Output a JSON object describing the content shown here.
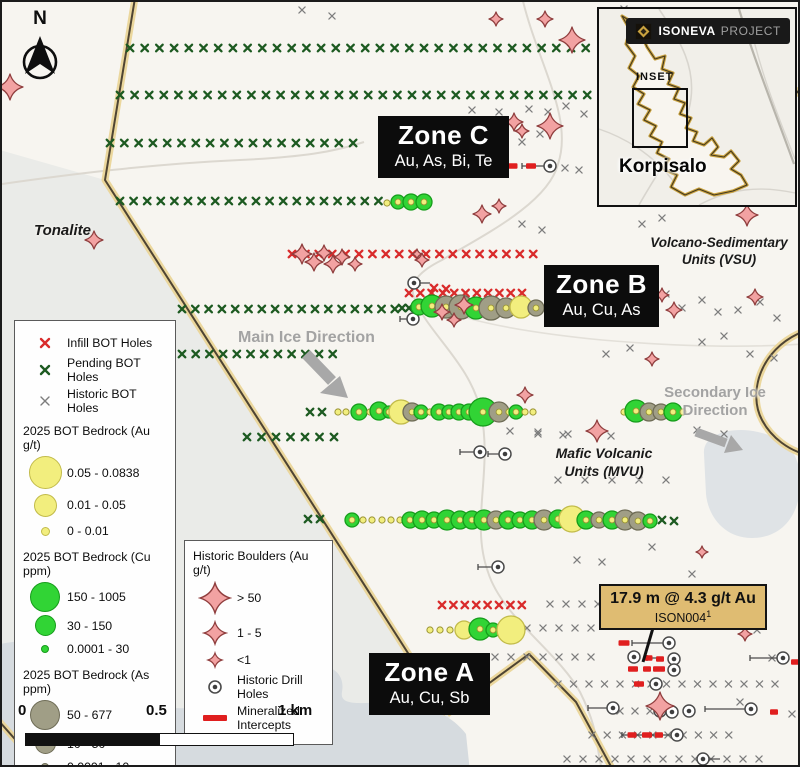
{
  "colors": {
    "map_bg": "#f7f5f0",
    "water": "#d6dbdf",
    "terrain": "#eaebe8",
    "patch": "#dfe3e6",
    "boundary_glow": "#ead598",
    "boundary_core": "#4e4433",
    "road": "#dcd8d0",
    "infill_x": "#d92b2b",
    "pending_x": "#1d5a21",
    "historic_x": "#7d7d7d",
    "au_fill": "#f2ee7e",
    "au_stroke": "#c2bb4a",
    "dot_stroke": "#9a9434",
    "cu_fill": "#31d435",
    "cu_stroke": "#169c1b",
    "as_fill": "#a09e86",
    "as_stroke": "#6e6c56",
    "boulder_fill": "#f2a2a2",
    "boulder_stroke": "#8f3d3d",
    "intercept": "#e01f1f",
    "ice_gray": "#a3a3a3",
    "zone_bg": "#0c0c0c",
    "annotation_bg": "#dfbc72"
  },
  "north": {
    "label": "N"
  },
  "inset": {
    "badge_brand": "ISONEVA",
    "badge_suffix": "PROJECT",
    "inset_label": "INSET",
    "region_label": "Korpisalo"
  },
  "zones": [
    {
      "title": "Zone C",
      "elements": "Au, As, Bi, Te"
    },
    {
      "title": "Zone B",
      "elements": "Au, Cu, As"
    },
    {
      "title": "Zone A",
      "elements": "Au, Cu, Sb"
    }
  ],
  "geology": {
    "tonalite": "Tonalite",
    "vsu_line1": "Volcano-Sedimentary",
    "vsu_line2": "Units (VSU)",
    "mvu_line1": "Mafic Volcanic",
    "mvu_line2": "Units (MVU)"
  },
  "ice": {
    "main": "Main Ice Direction",
    "secondary_line1": "Secondary Ice",
    "secondary_line2": "Direction"
  },
  "annotation": {
    "headline": "17.9 m @ 4.3 g/t Au",
    "hole_id": "ISON004",
    "footnote_mark": "1"
  },
  "scale_bar": {
    "tick0": "0",
    "tick_mid": "0.5",
    "tick_end": "1 km"
  },
  "legend_bedrock": {
    "items_x": [
      {
        "label": "Infill BOT Holes"
      },
      {
        "label": "Pending BOT Holes"
      },
      {
        "label": "Historic BOT Holes"
      }
    ],
    "sections": [
      {
        "title": "2025 BOT Bedrock (Au g/t)",
        "classes": [
          {
            "label": "0.05 - 0.0838"
          },
          {
            "label": "0.01 - 0.05"
          },
          {
            "label": "0 - 0.01"
          }
        ]
      },
      {
        "title": "2025 BOT Bedrock (Cu ppm)",
        "classes": [
          {
            "label": "150 - 1005"
          },
          {
            "label": "30 - 150"
          },
          {
            "label": "0.0001 - 30"
          }
        ]
      },
      {
        "title": "2025 BOT Bedrock (As ppm)",
        "classes": [
          {
            "label": "50 - 677"
          },
          {
            "label": "10 - 50"
          },
          {
            "label": "0.0001 - 10"
          }
        ]
      }
    ]
  },
  "legend_historic": {
    "title": "Historic Boulders (Au g/t)",
    "classes": [
      {
        "label": "> 50"
      },
      {
        "label": "1 - 5"
      },
      {
        "label": "<1"
      }
    ],
    "drill_label": "Historic Drill Holes",
    "intercept_label": "Mineralized Intercepts"
  },
  "map_markers": {
    "x_rows": [
      [
        "pending",
        46,
        128,
        598,
        14.7
      ],
      [
        "pending",
        93,
        118,
        598,
        14.6
      ],
      [
        "pending",
        141,
        108,
        358,
        14.3
      ],
      [
        "pending",
        199,
        118,
        378,
        13.6
      ],
      [
        "pending",
        307,
        180,
        406,
        13.3
      ],
      [
        "pending",
        352,
        180,
        331,
        13.7
      ],
      [
        "pending",
        435,
        245,
        332,
        14.5
      ],
      [
        "infill",
        252,
        290,
        532,
        13.4
      ],
      [
        "infill",
        291,
        407,
        531,
        11.3
      ],
      [
        "infill",
        603,
        440,
        520,
        11.4
      ],
      [
        "historic",
        602,
        548,
        598,
        16
      ],
      [
        "historic",
        626,
        525,
        591,
        16
      ],
      [
        "historic",
        655,
        493,
        591,
        16
      ],
      [
        "historic",
        682,
        556,
        788,
        15.5
      ],
      [
        "historic",
        709,
        618,
        650,
        15
      ],
      [
        "historic",
        733,
        590,
        738,
        15.2
      ],
      [
        "historic",
        757,
        565,
        757,
        16
      ],
      [
        "historic",
        478,
        556,
        670,
        27
      ]
    ],
    "x_scatter": {
      "pending": [
        [
          400,
          306
        ],
        [
          407,
          306
        ],
        [
          660,
          518
        ],
        [
          672,
          519
        ],
        [
          308,
          410
        ],
        [
          320,
          410
        ],
        [
          306,
          517
        ],
        [
          318,
          517
        ]
      ],
      "infill": [
        [
          432,
          286
        ],
        [
          444,
          287
        ]
      ],
      "historic": [
        [
          300,
          8
        ],
        [
          330,
          14
        ],
        [
          600,
          10
        ],
        [
          622,
          7
        ],
        [
          470,
          108
        ],
        [
          497,
          110
        ],
        [
          527,
          107
        ],
        [
          546,
          110
        ],
        [
          564,
          104
        ],
        [
          582,
          112
        ],
        [
          460,
          133
        ],
        [
          476,
          127
        ],
        [
          520,
          140
        ],
        [
          538,
          132
        ],
        [
          563,
          166
        ],
        [
          577,
          168
        ],
        [
          520,
          222
        ],
        [
          540,
          228
        ],
        [
          640,
          222
        ],
        [
          660,
          216
        ],
        [
          596,
          318
        ],
        [
          612,
          306
        ],
        [
          628,
          318
        ],
        [
          648,
          300
        ],
        [
          664,
          292
        ],
        [
          680,
          306
        ],
        [
          700,
          298
        ],
        [
          716,
          310
        ],
        [
          736,
          308
        ],
        [
          758,
          300
        ],
        [
          775,
          316
        ],
        [
          700,
          340
        ],
        [
          722,
          334
        ],
        [
          748,
          352
        ],
        [
          772,
          356
        ],
        [
          604,
          352
        ],
        [
          628,
          346
        ],
        [
          508,
          429
        ],
        [
          536,
          432
        ],
        [
          561,
          433
        ],
        [
          609,
          434
        ],
        [
          695,
          428
        ],
        [
          722,
          432
        ],
        [
          536,
          430
        ],
        [
          566,
          432
        ],
        [
          575,
          558
        ],
        [
          600,
          560
        ],
        [
          650,
          545
        ],
        [
          690,
          572
        ],
        [
          700,
          622
        ],
        [
          755,
          628
        ],
        [
          770,
          656
        ],
        [
          738,
          700
        ],
        [
          790,
          712
        ]
      ]
    },
    "drill_lines": [
      [
        520,
        164,
        544,
        164
      ],
      [
        418,
        281,
        428,
        281
      ],
      [
        398,
        317,
        408,
        317
      ],
      [
        458,
        450,
        474,
        450
      ],
      [
        486,
        452,
        499,
        452
      ],
      [
        476,
        565,
        492,
        565
      ],
      [
        630,
        641,
        662,
        641
      ],
      [
        645,
        656,
        657,
        656
      ],
      [
        748,
        656,
        776,
        656
      ],
      [
        586,
        706,
        606,
        706
      ],
      [
        703,
        707,
        744,
        707
      ],
      [
        620,
        733,
        670,
        733
      ],
      [
        706,
        757,
        718,
        757
      ]
    ],
    "intercepts": [
      [
        511,
        164,
        9
      ],
      [
        529,
        164,
        10
      ],
      [
        622,
        641,
        11
      ],
      [
        646,
        656,
        9
      ],
      [
        658,
        657,
        8
      ],
      [
        793,
        660,
        8
      ],
      [
        631,
        667,
        10
      ],
      [
        645,
        667,
        8
      ],
      [
        657,
        667,
        12
      ],
      [
        637,
        682,
        10
      ],
      [
        772,
        710,
        8
      ],
      [
        630,
        733,
        9
      ],
      [
        645,
        733,
        10
      ],
      [
        657,
        733,
        8
      ]
    ],
    "drill_holes": [
      [
        548,
        164
      ],
      [
        412,
        281
      ],
      [
        411,
        317
      ],
      [
        478,
        450
      ],
      [
        503,
        452
      ],
      [
        496,
        565
      ],
      [
        667,
        641
      ],
      [
        632,
        655
      ],
      [
        672,
        657
      ],
      [
        781,
        656
      ],
      [
        672,
        668
      ],
      [
        654,
        682
      ],
      [
        611,
        706
      ],
      [
        658,
        709
      ],
      [
        670,
        710
      ],
      [
        687,
        709
      ],
      [
        749,
        707
      ],
      [
        675,
        733
      ],
      [
        701,
        757
      ]
    ],
    "bubbles": [
      [
        385,
        201,
        3,
        "dot"
      ],
      [
        396,
        200,
        7,
        "cu"
      ],
      [
        409,
        200,
        8,
        "cu"
      ],
      [
        422,
        200,
        8,
        "cu"
      ],
      [
        417,
        305,
        8,
        "cu"
      ],
      [
        430,
        304,
        11,
        "cu"
      ],
      [
        444,
        305,
        11,
        "as"
      ],
      [
        459,
        305,
        12,
        "as"
      ],
      [
        474,
        306,
        11,
        "cu"
      ],
      [
        489,
        306,
        12,
        "as"
      ],
      [
        504,
        306,
        10,
        "as"
      ],
      [
        519,
        305,
        11,
        "au"
      ],
      [
        534,
        306,
        8,
        "as"
      ],
      [
        336,
        410,
        3,
        "dot"
      ],
      [
        344,
        410,
        3,
        "dot"
      ],
      [
        357,
        410,
        8,
        "cu"
      ],
      [
        368,
        410,
        3,
        "dot"
      ],
      [
        377,
        409,
        9,
        "cu"
      ],
      [
        387,
        410,
        6,
        "cu"
      ],
      [
        399,
        410,
        12,
        "au"
      ],
      [
        410,
        410,
        9,
        "as"
      ],
      [
        419,
        410,
        7,
        "cu"
      ],
      [
        428,
        410,
        3,
        "dot"
      ],
      [
        437,
        410,
        8,
        "cu"
      ],
      [
        447,
        410,
        7,
        "cu"
      ],
      [
        457,
        410,
        8,
        "cu"
      ],
      [
        467,
        410,
        8,
        "cu"
      ],
      [
        481,
        410,
        14,
        "cu"
      ],
      [
        497,
        410,
        10,
        "as"
      ],
      [
        507,
        410,
        3,
        "dot"
      ],
      [
        514,
        410,
        7,
        "cu"
      ],
      [
        523,
        410,
        3,
        "dot"
      ],
      [
        531,
        410,
        3,
        "dot"
      ],
      [
        622,
        410,
        3,
        "dot"
      ],
      [
        634,
        409,
        11,
        "cu"
      ],
      [
        647,
        410,
        9,
        "as"
      ],
      [
        659,
        410,
        8,
        "as"
      ],
      [
        671,
        410,
        9,
        "cu"
      ],
      [
        681,
        410,
        3,
        "dot"
      ],
      [
        350,
        518,
        7,
        "cu"
      ],
      [
        361,
        518,
        3,
        "dot"
      ],
      [
        370,
        518,
        3,
        "dot"
      ],
      [
        380,
        518,
        3,
        "dot"
      ],
      [
        389,
        518,
        3,
        "dot"
      ],
      [
        398,
        518,
        3,
        "dot"
      ],
      [
        408,
        518,
        8,
        "cu"
      ],
      [
        420,
        518,
        9,
        "cu"
      ],
      [
        432,
        518,
        8,
        "cu"
      ],
      [
        445,
        518,
        10,
        "cu"
      ],
      [
        458,
        518,
        9,
        "cu"
      ],
      [
        470,
        518,
        9,
        "cu"
      ],
      [
        482,
        518,
        10,
        "cu"
      ],
      [
        494,
        518,
        9,
        "as"
      ],
      [
        506,
        518,
        9,
        "cu"
      ],
      [
        518,
        518,
        8,
        "cu"
      ],
      [
        530,
        518,
        9,
        "cu"
      ],
      [
        542,
        518,
        10,
        "as"
      ],
      [
        556,
        517,
        9,
        "cu"
      ],
      [
        570,
        517,
        13,
        "au"
      ],
      [
        584,
        518,
        9,
        "cu"
      ],
      [
        597,
        518,
        8,
        "as"
      ],
      [
        610,
        518,
        9,
        "cu"
      ],
      [
        623,
        518,
        10,
        "as"
      ],
      [
        636,
        519,
        9,
        "as"
      ],
      [
        648,
        519,
        7,
        "cu"
      ],
      [
        428,
        628,
        3,
        "dot"
      ],
      [
        438,
        628,
        3,
        "dot"
      ],
      [
        448,
        628,
        3,
        "dot"
      ],
      [
        462,
        628,
        9,
        "au"
      ],
      [
        478,
        627,
        11,
        "cu"
      ],
      [
        491,
        628,
        7,
        "cu"
      ],
      [
        509,
        628,
        14,
        "au"
      ]
    ],
    "boulders": [
      [
        8,
        85,
        13
      ],
      [
        92,
        238,
        9
      ],
      [
        300,
        252,
        10
      ],
      [
        312,
        260,
        9
      ],
      [
        322,
        251,
        8
      ],
      [
        331,
        262,
        9
      ],
      [
        340,
        255,
        8
      ],
      [
        353,
        262,
        7
      ],
      [
        415,
        252,
        5
      ],
      [
        420,
        258,
        7
      ],
      [
        440,
        310,
        8
      ],
      [
        462,
        303,
        9
      ],
      [
        452,
        318,
        7
      ],
      [
        480,
        212,
        9
      ],
      [
        497,
        204,
        7
      ],
      [
        512,
        120,
        9
      ],
      [
        520,
        129,
        7
      ],
      [
        548,
        124,
        13
      ],
      [
        570,
        38,
        13
      ],
      [
        543,
        17,
        8
      ],
      [
        494,
        17,
        7
      ],
      [
        660,
        293,
        7
      ],
      [
        672,
        308,
        8
      ],
      [
        650,
        357,
        7
      ],
      [
        745,
        213,
        11
      ],
      [
        753,
        295,
        8
      ],
      [
        523,
        393,
        8
      ],
      [
        595,
        429,
        11
      ],
      [
        700,
        550,
        6
      ],
      [
        743,
        632,
        7
      ],
      [
        658,
        704,
        14
      ]
    ]
  }
}
